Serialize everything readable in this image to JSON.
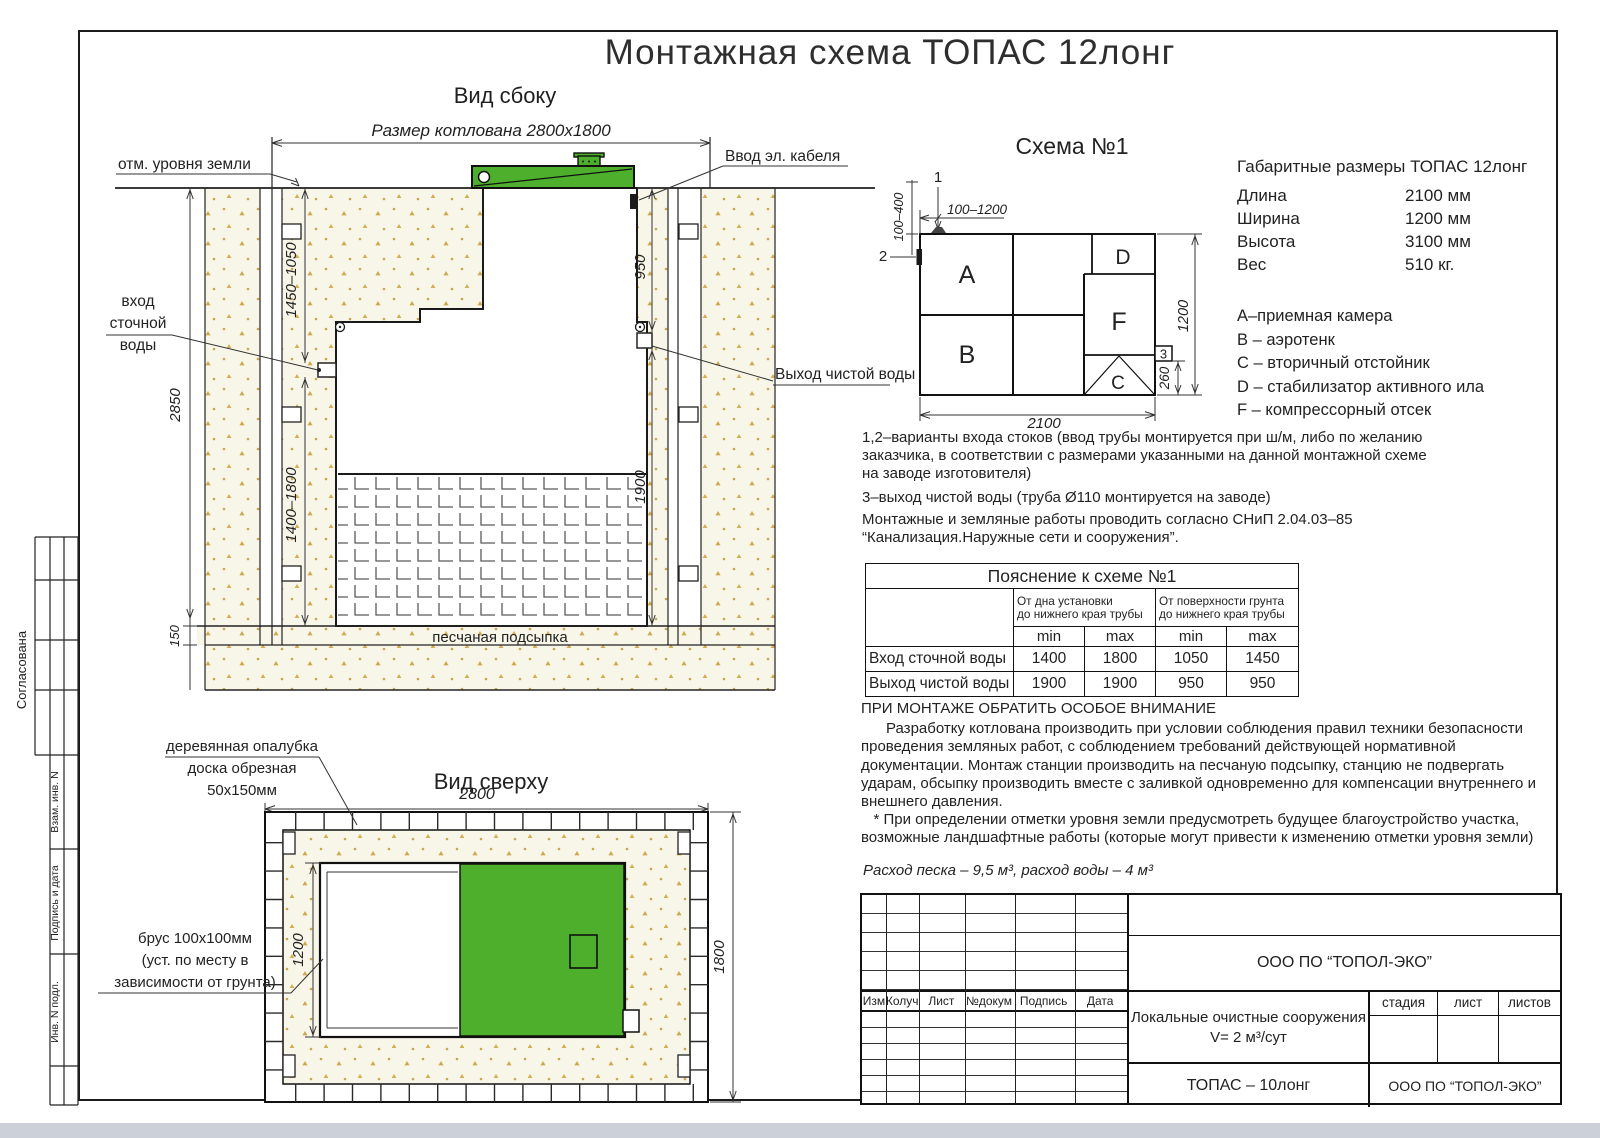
{
  "title": "Монтажная схема ТОПАС 12лонг",
  "side_view": {
    "label": "Вид сбоку",
    "pit_size_label": "Размер котлована 2800х1800",
    "ground_label": "отм. уровня земли",
    "cable_label": "Ввод эл. кабеля",
    "inlet_lines": [
      "вход",
      "сточной",
      "воды"
    ],
    "outlet_label": "Выход чистой воды",
    "sand_bed_label": "песчаная подсыпка",
    "dims": {
      "depth": "2850",
      "sand": "150",
      "inlet_upper": "1450–1050",
      "inlet_lower": "1400–1800",
      "outlet_upper": "950",
      "outlet_lower": "1900"
    }
  },
  "top_view": {
    "label": "Вид сверху",
    "formwork_lines": [
      "деревянная опалубка",
      "доска обрезная",
      "50х150мм"
    ],
    "beam_lines": [
      "брус 100х100мм",
      "(уст. по месту в",
      "зависимости от грунта)"
    ],
    "dims": {
      "width": "2800",
      "depth": "1800",
      "station": "1200"
    }
  },
  "scheme": {
    "label": "Схема №1",
    "chambers": {
      "a": "A",
      "b": "B",
      "c": "C",
      "d": "D",
      "f": "F"
    },
    "markers": {
      "m1": "1",
      "m2": "2",
      "m3": "3"
    },
    "dims": {
      "length": "2100",
      "width": "1200",
      "outlet": "260",
      "inlet_range_h": "100–1200",
      "inlet_range_v": "100–400"
    }
  },
  "specs": {
    "title": "Габаритные размеры ТОПАС 12лонг",
    "rows": [
      {
        "label": "Длина",
        "value": "2100 мм"
      },
      {
        "label": "Ширина",
        "value": "1200 мм"
      },
      {
        "label": "Высота",
        "value": "3100 мм"
      },
      {
        "label": "Вес",
        "value": "510 кг."
      }
    ],
    "legend": [
      "А–приемная камера",
      "В – аэротенк",
      "С – вторичный отстойник",
      "D – стабилизатор активного  ила",
      "F  – компрессорный отсек"
    ]
  },
  "notes": {
    "lines": [
      "1,2–варианты входа  стоков (ввод трубы монтируется при ш/м, либо по желанию",
      "заказчика, в соответствии с размерами указанными на данной монтажной схеме",
      "на заводе изготовителя)",
      "3–выход чистой воды (труба Ø110 монтируется на заводе)",
      "Монтажные и земляные работы проводить согласно СНиП 2.04.03–85",
      "“Канализация.Наружные сети и сооружения”."
    ]
  },
  "explain_table": {
    "title": "Пояснение к схеме №1",
    "group1": "От дна установки\nдо нижнего края трубы",
    "group2": "От поверхности грунта\nдо нижнего края трубы",
    "min": "min",
    "max": "max",
    "rows": [
      {
        "label": "Вход сточной воды",
        "values": [
          "1400",
          "1800",
          "1050",
          "1450"
        ]
      },
      {
        "label": "Выход чистой воды",
        "values": [
          "1900",
          "1900",
          "950",
          "950"
        ]
      }
    ]
  },
  "attention": {
    "title": "ПРИ МОНТАЖЕ ОБРАТИТЬ ОСОБОЕ ВНИМАНИЕ",
    "lines": [
      "      Разработку котлована производить при условии соблюдения правил техники безопасности",
      "проведения земляных работ, с соблюдением требований действующей нормативной",
      "документации. Монтаж станции производить на песчаную подсыпку, станцию не подвергать",
      "ударам, обсыпку производить вместе с заливкой одновременно для компенсации внутреннего и",
      "внешнего давления.",
      "   * При определении отметки уровня земли предусмотреть будущее благоустройство участка,",
      "возможные ландшафтные работы (которые могут привести к изменению отметки уровня земли)"
    ],
    "consumption": "Расход песка – 9,5 м³, расход воды – 4 м³"
  },
  "stamp": {
    "org": "ООО ПО “ТОПОЛ-ЭКО”",
    "columns": [
      "Изм",
      "Колуч",
      "Лист",
      "№докум",
      "Подпись",
      "Дата"
    ],
    "project": [
      "Локальные очистные сооружения",
      "V= 2 м³/сут"
    ],
    "stage_label": "стадия",
    "sheet_label": "лист",
    "sheets_label": "листов",
    "product": "ТОПАС – 10лонг",
    "org2": "ООО ПО “ТОПОЛ-ЭКО”"
  },
  "margin": {
    "approved": "Согласована",
    "vzam": "Взам. инв. N",
    "podp": "Подпись и дата",
    "inv": "Инв. N подл."
  },
  "colors": {
    "green": "#4daf2b",
    "sand_dot": "#cfa94f",
    "paper": "#f8f6e8"
  }
}
